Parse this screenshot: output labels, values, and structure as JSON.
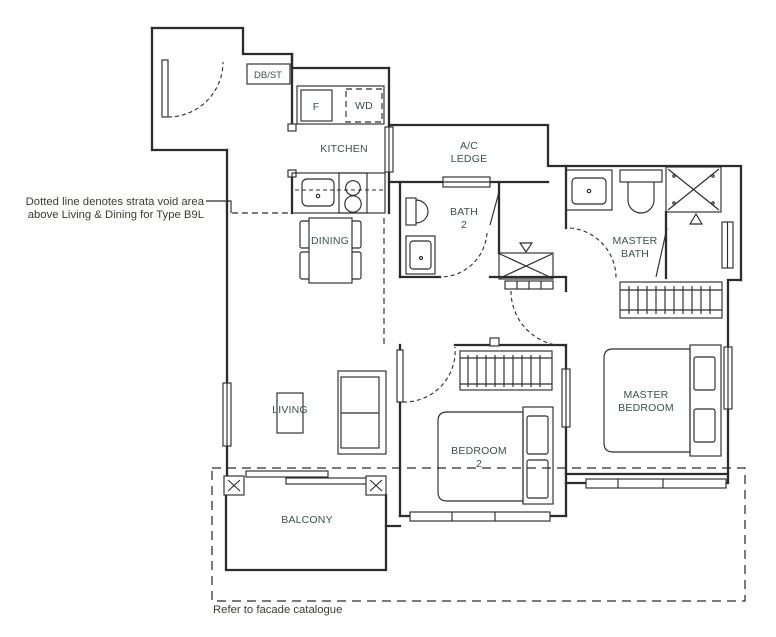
{
  "drawing_type": "apartment floor plan",
  "unit_type": "B9L",
  "rooms": {
    "kitchen": "KITCHEN",
    "db_st": "DB/ST",
    "fridge": "F",
    "washer_dryer": "WD",
    "ac_ledge": [
      "A/C",
      "LEDGE"
    ],
    "bath2": [
      "BATH",
      "2"
    ],
    "master_bath": [
      "MASTER",
      "BATH"
    ],
    "dining": "DINING",
    "living": "LIVING",
    "bedroom2": [
      "BEDROOM",
      "2"
    ],
    "master_bedroom": [
      "MASTER",
      "BEDROOM"
    ],
    "balcony": "BALCONY"
  },
  "annotations": {
    "strata_void_note": [
      "Dotted line denotes strata void area",
      "above Living & Dining for Type B9L"
    ],
    "facade_note": "Refer to facade catalogue"
  },
  "fixtures": [
    "entry-door",
    "db-storage-cabinet",
    "fridge",
    "washer-dryer",
    "kitchen-counter-sink",
    "cooker-hob",
    "dining-table-with-chairs",
    "toilet",
    "wash-basin",
    "shower",
    "shaft",
    "sofa",
    "coffee-table",
    "double-bed",
    "wardrobe",
    "balcony-columns",
    "sliding-door"
  ],
  "colors": {
    "background": "#ffffff",
    "wall_line": "#2c2c2c",
    "room_label": "#3a524e",
    "note_text": "#3c3c33"
  }
}
